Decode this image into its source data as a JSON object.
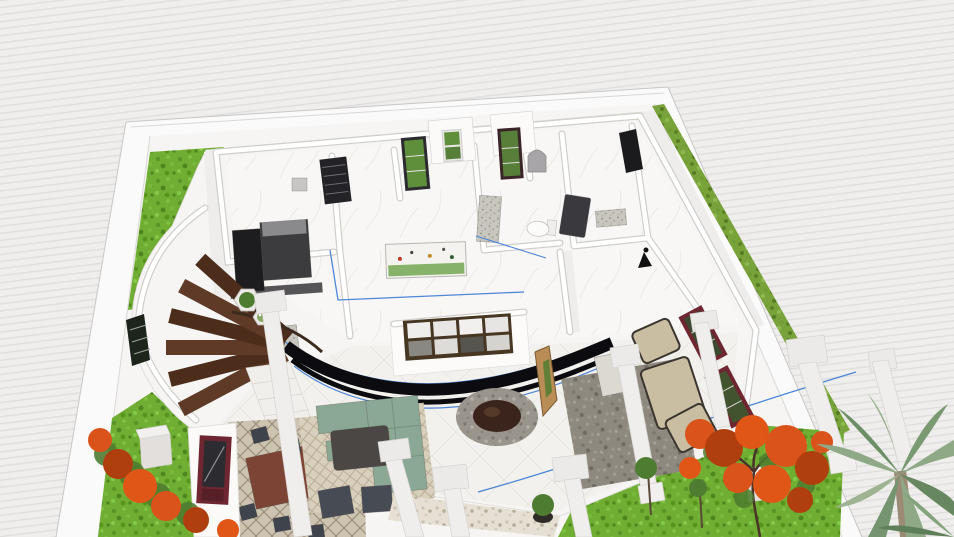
{
  "meta": {
    "description": "Bird's-eye 3D render of a furnished one-storey house plan with curved stair, terrace, pergola columns and landscaped garden",
    "visible_text": []
  },
  "colors": {
    "background_base": "#efeeed",
    "background_stripe": "#dfdddc",
    "plot_ground": "#f6f5f3",
    "boundary_wall": "#fbfafa",
    "boundary_wall_edge": "#c9c7c5",
    "boundary_wall_edge_soft": "#dad8d6",
    "house_floor": "#f6f5f3",
    "house_edge": "#dcdad7",
    "wall_face_shade": "#efedeb",
    "window_wall_face": "#fcfbfa",
    "appliance_black": "#1d1d1f",
    "appliance_gray": "#3c3c3e",
    "appliance_top": "#8a8a8c",
    "louver_door": "#232327",
    "door_frame_dark": "#2c2c30",
    "door_frame_maroon_dark": "#3a2428",
    "glass_green": "#5f8f3b",
    "glass_green_dark": "#587f39",
    "doorway_dark": "#1b1b1e",
    "arch_mirror": "#a7a5a7",
    "tv_dark": "#3a3a3e",
    "lamp_black": "#111111",
    "partition_black": "#0c0c10",
    "selection_blue": "#4d86d8",
    "stair_wood": "#5f3a26",
    "stair_wood_dark": "#4c2c1a",
    "stair_rail": "#3c2a1e",
    "step_white": "#f1efec",
    "vent_dark": "#1c241c",
    "planter_rim": "#eceae6",
    "plant_green": "#4e7c30",
    "fire_pit_core": "#3a241c",
    "sofa_sage": "#8ba795",
    "sofa_sage_line": "#74907f",
    "coffee_table_dark": "#4b4744",
    "armchair_dark": "#474b54",
    "dining_table_wood": "#7c4434",
    "chair_dark": "#3f434c",
    "window_frame_maroon": "#6e2731",
    "window_glass_dark": "#2c2c30",
    "wicker_tan": "#c9bda2",
    "wicker_frame": "#3a352e",
    "side_table": "#dcd9d3",
    "decor_panel_tan": "#b98d55",
    "column_white": "#f0eeec",
    "column_cap": "#eceae8",
    "pedestal_top": "#f2f0ee",
    "pedestal_front": "#e2dfdc",
    "pot_dark": "#2e2a26",
    "trunk_brown": "#5a4a3a",
    "tree_orange": "#d9531b",
    "tree_orange_dark": "#b03f10",
    "tree_orange_bright": "#e05617",
    "tree_green": "#4e7c30",
    "palm_green": "#8fa986",
    "palm_green_dark": "#6d8f66",
    "palm_green_light": "#9db392",
    "palm_trunk": "#9b8a74",
    "lawn_base": "#6fae33",
    "hedge_base": "#78a23a"
  },
  "scene": {
    "objects": [
      {
        "id": "boundary-wall",
        "label": "white plot boundary wall"
      },
      {
        "id": "lawn",
        "label": "grass lawn patches"
      },
      {
        "id": "hedge-row",
        "label": "hedge strip along east wall"
      },
      {
        "id": "house",
        "label": "white-walled single storey house"
      },
      {
        "id": "kitchen-unit",
        "label": "black kitchen fridge and cabinets"
      },
      {
        "id": "louver-door",
        "label": "dark louvered door"
      },
      {
        "id": "patio-door",
        "label": "glass doors showing garden"
      },
      {
        "id": "garden-window",
        "label": "window with greenery"
      },
      {
        "id": "arch-mirror",
        "label": "arched mirror"
      },
      {
        "id": "toilet",
        "label": "toilet"
      },
      {
        "id": "wall-tv",
        "label": "wall mounted TV"
      },
      {
        "id": "dresser",
        "label": "dresser"
      },
      {
        "id": "wall-painting",
        "label": "landscape painting"
      },
      {
        "id": "grid-window",
        "label": "large wood grid window"
      },
      {
        "id": "curved-partition",
        "label": "curved black glass partition"
      },
      {
        "id": "curved-staircase",
        "label": "curved wooden staircase"
      },
      {
        "id": "hex-planters",
        "label": "hexagonal planters"
      },
      {
        "id": "fire-pit",
        "label": "stone fire pit"
      },
      {
        "id": "sectional-sofa",
        "label": "sage green outdoor sectional"
      },
      {
        "id": "dining-set",
        "label": "wood dining table with chairs on lattice rug"
      },
      {
        "id": "wicker-set",
        "label": "wicker lounge furniture on gray rug"
      },
      {
        "id": "accent-window",
        "label": "maroon framed windows"
      },
      {
        "id": "pergola-columns",
        "label": "white pergola columns"
      },
      {
        "id": "stone-parapet",
        "label": "stone terrace parapet"
      },
      {
        "id": "flame-tree",
        "label": "orange flowering flame tree"
      },
      {
        "id": "palm-tree",
        "label": "palm tree"
      },
      {
        "id": "flower-bushes",
        "label": "orange flower bushes"
      }
    ]
  }
}
